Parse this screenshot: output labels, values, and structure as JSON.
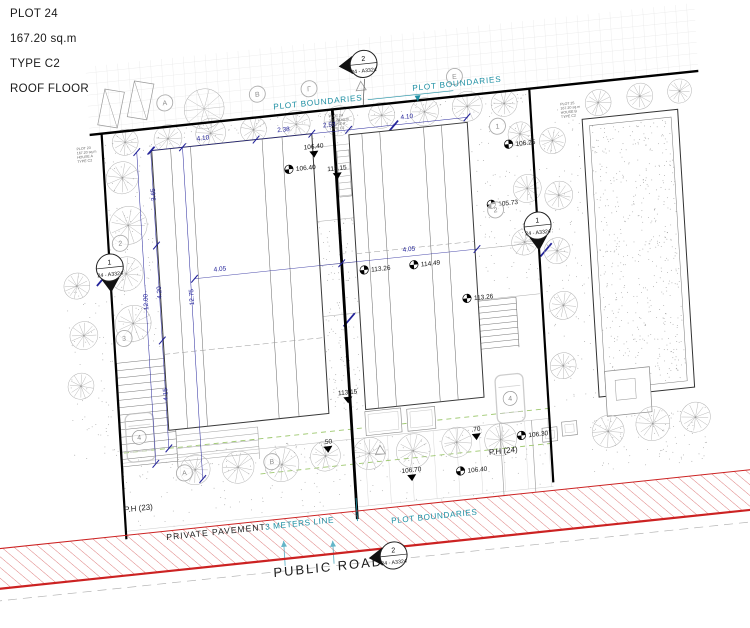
{
  "title_block": {
    "plot_id": "PLOT 24",
    "area": "167.20 sq.m",
    "type": "TYPE C2",
    "floor": "ROOF FLOOR"
  },
  "boundary_labels": {
    "top_left": "PLOT BOUNDARIES",
    "top_right": "PLOT BOUNDARIES",
    "bottom": "PLOT BOUNDARIES"
  },
  "road_labels": {
    "private_pavement": "PRIVATE PAVEMENT",
    "three_meters_line": "3 METERS LINE",
    "public_road": "PUBLIC ROAD"
  },
  "parking_labels": {
    "left": "P.H (23)",
    "right": "P.H (24)"
  },
  "callouts": {
    "top": {
      "number": "2",
      "sheet": "24 - A3324"
    },
    "left": {
      "number": "1",
      "sheet": "24 - A3324"
    },
    "right": {
      "number": "1",
      "sheet": "24 - A3324"
    },
    "bottom": {
      "number": "2",
      "sheet": "24 - A3324"
    }
  },
  "grid_bubbles": {
    "top": [
      "A",
      "B",
      "Γ",
      "E"
    ],
    "bottom": [
      "A",
      "B"
    ],
    "left": [
      "2",
      "3"
    ],
    "right": [
      "1",
      "2"
    ]
  },
  "spot_elevations": [
    "106.40",
    "113.26",
    "114.49",
    "113.26",
    "106.25",
    "105.73",
    "106.30",
    "106.40"
  ],
  "level_markers": [
    "106.40",
    "113.15",
    "113.15",
    "106.70",
    ".70",
    ".50"
  ],
  "dimensions": {
    "top": [
      "4.10",
      "2.38",
      "2.58",
      "4.10"
    ],
    "middle": [
      "4.05",
      "4.05"
    ],
    "left_vertical": [
      "3.65",
      "4.20",
      "4.15",
      "12.00",
      "12.75"
    ]
  },
  "mini_notes": {
    "left": [
      "PLOT 23",
      "167.20 sq.m",
      "HOUSE A",
      "TYPE C2"
    ],
    "center": [
      "PLOT 24",
      "167.20 sq.m",
      "HOUSE A",
      "TYPE C2"
    ],
    "right": [
      "PLOT 25",
      "167.20 sq.m",
      "HOUSE B",
      "TYPE C2"
    ],
    "parking_stall_left": "4",
    "parking_stall_right": "4"
  },
  "colors": {
    "dimension": "#23239a",
    "boundary_label": "#1d8fa3",
    "road": "#cc2222",
    "landscape_dash": "#9dc86e",
    "ink": "#111111"
  }
}
